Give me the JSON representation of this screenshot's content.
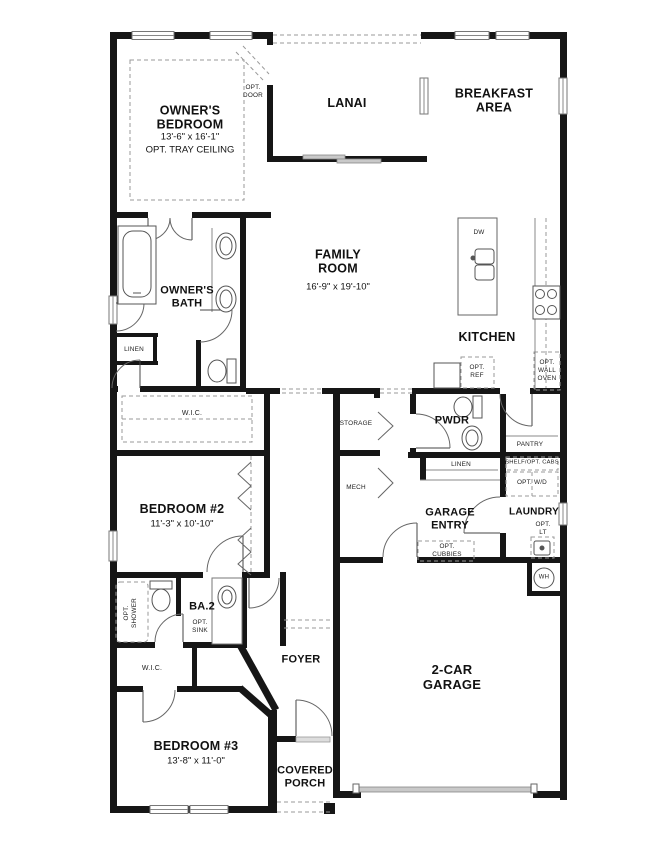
{
  "plan": {
    "rooms": {
      "owners_bedroom": {
        "label": "OWNER'S BEDROOM",
        "dims": "13'-6\" x 16'-1\"",
        "note": "OPT. TRAY CEILING"
      },
      "lanai": {
        "label": "LANAI"
      },
      "breakfast": {
        "label": "BREAKFAST AREA"
      },
      "family": {
        "label": "FAMILY ROOM",
        "dims": "16'-9\" x 19'-10\""
      },
      "kitchen": {
        "label": "KITCHEN"
      },
      "owners_bath": {
        "label": "OWNER'S BATH"
      },
      "wic1": {
        "label": "W.I.C."
      },
      "bedroom2": {
        "label": "BEDROOM #2",
        "dims": "11'-3\" x 10'-10\""
      },
      "ba2": {
        "label": "BA.2"
      },
      "wic2": {
        "label": "W.I.C."
      },
      "bedroom3": {
        "label": "BEDROOM #3",
        "dims": "13'-8\" x 11'-0\""
      },
      "foyer": {
        "label": "FOYER"
      },
      "covered_porch": {
        "label": "COVERED PORCH"
      },
      "garage": {
        "label": "2-CAR GARAGE"
      },
      "garage_entry": {
        "label": "GARAGE ENTRY"
      },
      "laundry": {
        "label": "LAUNDRY"
      },
      "pwdr": {
        "label": "PWDR"
      },
      "pantry": {
        "label": "PANTRY"
      },
      "storage": {
        "label": "STORAGE"
      },
      "mech": {
        "label": "MECH"
      }
    },
    "callouts": {
      "opt_door": "OPT. DOOR",
      "linen_bath": "LINEN",
      "linen_hall": "LINEN",
      "dw": "DW",
      "opt_ref": "OPT. REF",
      "opt_wall_oven": "OPT. WALL OVEN",
      "opt_cubbies": "OPT. CUBBIES",
      "shelf_opt_cabs": "SHELF/OPT. CABS",
      "opt_wd": "OPT. W/D",
      "opt_lt": "OPT. LT",
      "wh": "WH",
      "opt_shower": "OPT. SHOWER",
      "opt_sink": "OPT. SINK"
    },
    "colors": {
      "wall": "#161616",
      "line": "#555555",
      "dash": "#999999",
      "glass": "#c9c9c9"
    }
  }
}
